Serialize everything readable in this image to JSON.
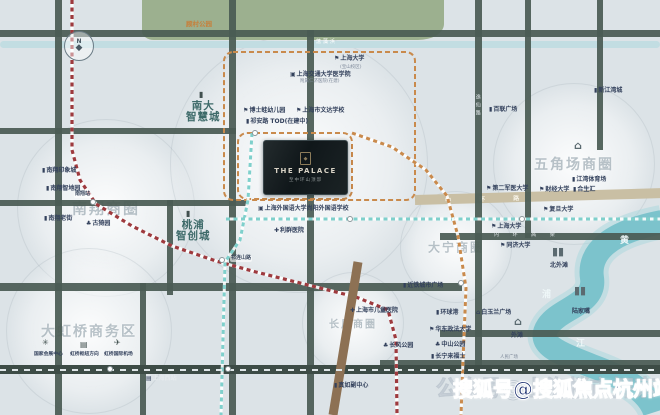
{
  "map": {
    "project": {
      "name": "THE PALACE",
      "subtitle": "至中环山顶邸",
      "emblem": "◆"
    },
    "compass": {
      "letter": "N",
      "needle": "◆"
    },
    "watermark": {
      "bold": "搜狐号@搜狐焦点杭州站",
      "faint": "公众号@上海楼市探索"
    },
    "park": {
      "label": "顾村公园"
    },
    "colors": {
      "road": "#4a5b54",
      "ring_beige": "#c9bfa4",
      "metro_red": "#9e3a3e",
      "metro_orange": "#c98a4c",
      "metro_teal": "#7fd0cc",
      "elevated_brown": "#8d7154",
      "river": "#7cc3cc",
      "park_green": "#9cb08f",
      "label_navy": "#33415c",
      "district_teal": "#3d6a69",
      "watermark_navy": "#1c3170"
    },
    "circles": [
      {
        "name": "nanxiang-district",
        "x": 105,
        "y": 207,
        "r": 88,
        "label": "南翔商圈",
        "fs": 15
      },
      {
        "name": "hongqiao-district",
        "x": 88,
        "y": 330,
        "r": 82,
        "label": "大虹桥商务区",
        "fs": 14
      },
      {
        "name": "project-halo",
        "x": 298,
        "y": 163,
        "r": 128,
        "label": "",
        "fs": 0
      },
      {
        "name": "wujiaochang-district",
        "x": 573,
        "y": 163,
        "r": 80,
        "label": "五角场商圈",
        "fs": 14
      },
      {
        "name": "changfeng-district",
        "x": 352,
        "y": 322,
        "r": 50,
        "label": "长风商圈",
        "fs": 10
      },
      {
        "name": "daning-district",
        "x": 455,
        "y": 246,
        "r": 55,
        "label": "大宁商圈",
        "fs": 12
      }
    ],
    "roads": [
      {
        "x": 0,
        "y": 30,
        "w": 660,
        "h": 7
      },
      {
        "x": 0,
        "y": 128,
        "w": 236,
        "h": 6
      },
      {
        "x": 0,
        "y": 200,
        "w": 248,
        "h": 6
      },
      {
        "x": 0,
        "y": 283,
        "w": 462,
        "h": 8
      },
      {
        "x": 440,
        "y": 233,
        "w": 220,
        "h": 7
      },
      {
        "x": 440,
        "y": 330,
        "w": 220,
        "h": 7
      },
      {
        "x": 380,
        "y": 360,
        "w": 280,
        "h": 7
      },
      {
        "x": 55,
        "y": 0,
        "w": 7,
        "h": 415
      },
      {
        "x": 229,
        "y": 0,
        "w": 7,
        "h": 415
      },
      {
        "x": 307,
        "y": 30,
        "w": 7,
        "h": 385
      },
      {
        "x": 140,
        "y": 283,
        "w": 6,
        "h": 132
      },
      {
        "x": 167,
        "y": 200,
        "w": 6,
        "h": 95
      },
      {
        "x": 475,
        "y": 0,
        "w": 7,
        "h": 372
      },
      {
        "x": 525,
        "y": 0,
        "w": 6,
        "h": 238
      },
      {
        "x": 597,
        "y": 0,
        "w": 6,
        "h": 150
      }
    ],
    "railband": {
      "x": 0,
      "y": 365,
      "w": 660,
      "h": 9
    },
    "beige_road": {
      "x": 415,
      "y": 195,
      "w": 248,
      "h": 10,
      "label": "中  环  路"
    },
    "lines": [
      {
        "name": "metro-line-11",
        "color": "#9e3a3e",
        "w": 3.2,
        "dash": "4 3.5",
        "casing": true,
        "pts": "72,0 72,150 80,180 96,204 132,226 172,246 216,261 256,272 312,286 356,297 388,310 396,340 397,415"
      },
      {
        "name": "metro-line-15",
        "color": "#7fd0cc",
        "w": 3,
        "dash": "4 3.5",
        "casing": true,
        "pts": "252,133 248,200 240,240 225,262 221,415"
      },
      {
        "name": "metro-line-east-west",
        "color": "#7fd0cc",
        "w": 3,
        "dash": "4 3.5",
        "casing": true,
        "pts": "226,219 660,219"
      },
      {
        "name": "metro-line-7",
        "color": "#c98a4c",
        "w": 3,
        "dash": "4 3.5",
        "casing": true,
        "pts": "352,133 392,147 426,170 447,196 458,236 466,288 463,360 461,415"
      },
      {
        "name": "north-south-elevated-road",
        "color": "#8d7154",
        "w": 9,
        "dash": null,
        "casing": false,
        "pts": "358,262 333,415"
      },
      {
        "name": "railway-dashes",
        "color": "#dfe6e8",
        "w": 2,
        "dash": "6 6",
        "casing": false,
        "pts": "0,370 660,370"
      }
    ],
    "borders": [
      {
        "name": "nanda-smart-city-boundary",
        "x": 224,
        "y": 52,
        "w": 191,
        "h": 148
      },
      {
        "name": "project-plot-boundary",
        "x": 238,
        "y": 133,
        "w": 114,
        "h": 66
      }
    ],
    "stations": [
      {
        "x": 93,
        "y": 202
      },
      {
        "x": 255,
        "y": 133
      },
      {
        "x": 222,
        "y": 260
      },
      {
        "x": 110,
        "y": 369
      },
      {
        "x": 228,
        "y": 369
      },
      {
        "x": 350,
        "y": 219
      },
      {
        "x": 522,
        "y": 219
      },
      {
        "x": 461,
        "y": 283
      }
    ],
    "labels": [
      {
        "t": "顾村公园",
        "x": 186,
        "y": 21,
        "cls": "orange"
      },
      {
        "t": "蕰藻浜",
        "x": 316,
        "y": 40,
        "cls": "river-name"
      },
      {
        "t": "上海大学",
        "x": 334,
        "y": 56,
        "icon": "flag"
      },
      {
        "t": "(宝山校区)",
        "x": 340,
        "y": 65,
        "cls": "sub"
      },
      {
        "t": "上海交通大学医学院",
        "x": 290,
        "y": 72,
        "icon": "school"
      },
      {
        "t": "附属仁济医院(在建)",
        "x": 300,
        "y": 79,
        "cls": "sub"
      },
      {
        "t": "南大\n智慧城",
        "x": 186,
        "y": 101,
        "cls": "district"
      },
      {
        "t": "",
        "x": 199,
        "y": 91,
        "icon": "building",
        "cls": "mid-icon"
      },
      {
        "t": "博士蛙幼儿园",
        "x": 243,
        "y": 108,
        "icon": "flag"
      },
      {
        "t": "上海市文达学校",
        "x": 296,
        "y": 108,
        "icon": "flag"
      },
      {
        "t": "祁安路 TOD(在建中)",
        "x": 246,
        "y": 119,
        "icon": "building"
      },
      {
        "t": "新江湾城",
        "x": 594,
        "y": 88,
        "icon": "building"
      },
      {
        "t": "百联广场",
        "x": 489,
        "y": 107,
        "icon": "building"
      },
      {
        "t": "逸仙路",
        "x": 474,
        "y": 94,
        "cls": "vroad"
      },
      {
        "t": "",
        "x": 574,
        "y": 140,
        "icon": "tower",
        "cls": "big-icon"
      },
      {
        "t": "江湾体育场",
        "x": 572,
        "y": 177,
        "icon": "building"
      },
      {
        "t": "财经大学",
        "x": 539,
        "y": 187,
        "icon": "flag"
      },
      {
        "t": "合生汇",
        "x": 573,
        "y": 187,
        "icon": "building"
      },
      {
        "t": "复旦大学",
        "x": 543,
        "y": 207,
        "icon": "flag"
      },
      {
        "t": "第二军医大学",
        "x": 486,
        "y": 186,
        "icon": "flag"
      },
      {
        "t": "上海大学",
        "x": 491,
        "y": 224,
        "icon": "flag"
      },
      {
        "t": "同济大学",
        "x": 500,
        "y": 243,
        "icon": "flag"
      },
      {
        "t": "北外滩",
        "x": 550,
        "y": 263
      },
      {
        "t": "",
        "x": 552,
        "y": 246,
        "icon": "twin-towers",
        "cls": "big-icon"
      },
      {
        "t": "桃浦\n智创城",
        "x": 176,
        "y": 220,
        "cls": "district"
      },
      {
        "t": "",
        "x": 186,
        "y": 210,
        "icon": "building",
        "cls": "mid-icon"
      },
      {
        "t": "上海外国语大学尚阳外国语学校",
        "x": 258,
        "y": 206,
        "icon": "school"
      },
      {
        "t": "利群医院",
        "x": 274,
        "y": 228,
        "icon": "hospital"
      },
      {
        "t": "祁连山路",
        "x": 230,
        "y": 256,
        "cls": "station-label"
      },
      {
        "t": "南翔站",
        "x": 74,
        "y": 192,
        "cls": "station-label"
      },
      {
        "t": "南翔印象城",
        "x": 42,
        "y": 168,
        "icon": "building"
      },
      {
        "t": "南翔智地园",
        "x": 46,
        "y": 186,
        "icon": "building"
      },
      {
        "t": "南翔老街",
        "x": 44,
        "y": 216,
        "icon": "building"
      },
      {
        "t": "古猗园",
        "x": 86,
        "y": 221,
        "icon": "tree"
      },
      {
        "t": "",
        "x": 42,
        "y": 339,
        "icon": "expo",
        "cls": "mid-icon"
      },
      {
        "t": "国家会展中心",
        "x": 34,
        "y": 352,
        "cls": "sub2"
      },
      {
        "t": "",
        "x": 80,
        "y": 341,
        "icon": "train",
        "cls": "mid-icon"
      },
      {
        "t": "虹桥枢纽方向",
        "x": 70,
        "y": 352,
        "cls": "sub2"
      },
      {
        "t": "",
        "x": 114,
        "y": 339,
        "icon": "plane",
        "cls": "mid-icon"
      },
      {
        "t": "虹桥国际机场",
        "x": 104,
        "y": 352,
        "cls": "sub2"
      },
      {
        "t": "上海西站",
        "x": 146,
        "y": 376,
        "icon": "train",
        "cls": "on-dark"
      },
      {
        "t": "真如副中心",
        "x": 334,
        "y": 383,
        "icon": "building"
      },
      {
        "t": "近铁城市广场",
        "x": 403,
        "y": 283,
        "icon": "building"
      },
      {
        "t": "上海市儿童医院",
        "x": 350,
        "y": 308,
        "icon": "hospital"
      },
      {
        "t": "长风公园",
        "x": 383,
        "y": 343,
        "icon": "tree"
      },
      {
        "t": "环球港",
        "x": 436,
        "y": 310,
        "icon": "building"
      },
      {
        "t": "华东政法大学",
        "x": 429,
        "y": 327,
        "icon": "flag"
      },
      {
        "t": "中山公园",
        "x": 435,
        "y": 342,
        "icon": "tree"
      },
      {
        "t": "长宁来福士",
        "x": 431,
        "y": 354,
        "icon": "building"
      },
      {
        "t": "白玉兰广场",
        "x": 476,
        "y": 310,
        "icon": "tower"
      },
      {
        "t": "",
        "x": 514,
        "y": 316,
        "icon": "tower",
        "cls": "big-icon"
      },
      {
        "t": "外滩",
        "x": 511,
        "y": 333
      },
      {
        "t": "人民广场",
        "x": 500,
        "y": 355,
        "cls": "sub"
      },
      {
        "t": "",
        "x": 574,
        "y": 285,
        "icon": "twin-towers",
        "cls": "big-icon"
      },
      {
        "t": "陆家嘴",
        "x": 572,
        "y": 309
      },
      {
        "t": "浦",
        "x": 542,
        "y": 290,
        "cls": "river-big"
      },
      {
        "t": "江",
        "x": 576,
        "y": 339,
        "cls": "river-big"
      },
      {
        "t": "黄",
        "x": 620,
        "y": 236,
        "cls": "river-big"
      },
      {
        "t": "内 环 高 架",
        "x": 494,
        "y": 233,
        "cls": "on-dark-sp"
      }
    ]
  }
}
